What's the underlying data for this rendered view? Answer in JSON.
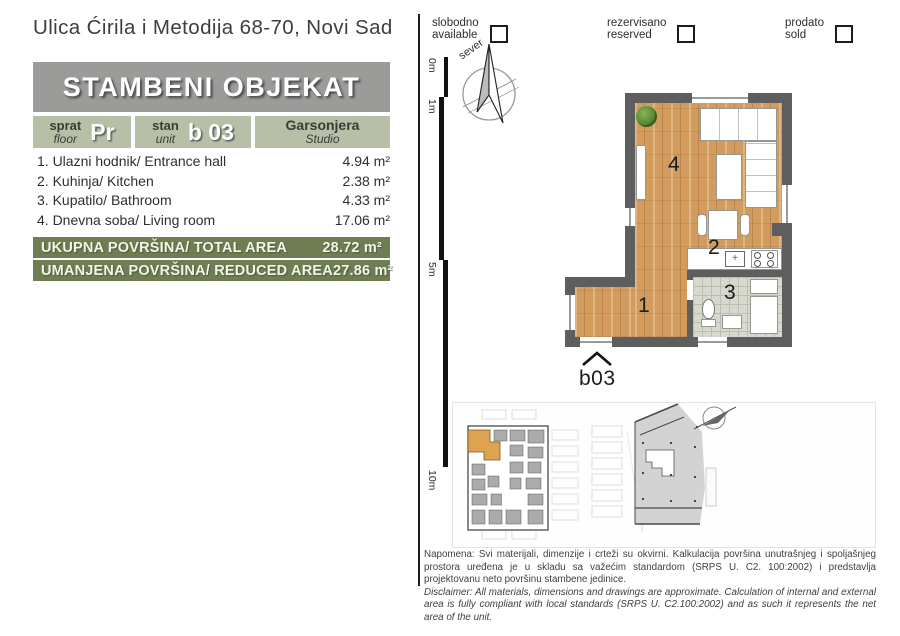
{
  "address": "Ulica Ćirila i Metodija 68-70, Novi Sad",
  "header": {
    "building_label": "STAMBENI OBJEKAT",
    "floor": {
      "sr": "sprat",
      "en": "floor",
      "value": "Pr"
    },
    "unit": {
      "sr": "stan",
      "en": "unit",
      "value": "b 03"
    },
    "apartment_type": {
      "sr": "Garsonjera",
      "en": "Studio"
    }
  },
  "rooms": [
    {
      "label": "1. Ulazni hodnik/ Entrance hall",
      "area": "4.94 m²"
    },
    {
      "label": "2. Kuhinja/ Kitchen",
      "area": "2.38 m²"
    },
    {
      "label": "3. Kupatilo/ Bathroom",
      "area": "4.33 m²"
    },
    {
      "label": "4. Dnevna soba/ Living room",
      "area": "17.06 m²"
    }
  ],
  "totals": {
    "total": {
      "label": "UKUPNA POVRŠINA/ TOTAL AREA",
      "value": "28.72 m²"
    },
    "reduced": {
      "label": "UMANJENA POVRŠINA/ REDUCED AREA",
      "value": "27.86 m²"
    }
  },
  "legend": {
    "available": {
      "sr": "slobodno",
      "en": "available"
    },
    "reserved": {
      "sr": "rezervisano",
      "en": "reserved"
    },
    "sold": {
      "sr": "prodato",
      "en": "sold"
    }
  },
  "compass": {
    "north": "sever"
  },
  "scale_marks": [
    "0m",
    "1m",
    "5m",
    "10m"
  ],
  "plan": {
    "unit_id": "b03",
    "room_numbers": {
      "hall": "1",
      "kitchen": "2",
      "bathroom": "3",
      "living": "4"
    }
  },
  "disclaimer": {
    "sr": "Napomena: Svi materijali, dimenzije i crteži su okvirni. Kalkulacija površina unutrašnjeg i spoljašnjeg prostora uređena je u skladu sa važećim standardom (SRPS U. C2. 100:2002) i predstavlja projektovanu neto površinu stambene jedinice.",
    "en": "Disclaimer: All materials, dimensions and drawings are approximate. Calculation of internal and external area is fully compliant with local standards (SRPS U. C2.100:2002) and as such it represents the net area of the unit."
  },
  "colors": {
    "banner_gray": "#9b9b99",
    "sage_green": "#b7bfa7",
    "olive_bar": "#6e7d52",
    "wood_floor": "#d39c5f",
    "wall_gray": "#5e5e5e",
    "unit_highlight_orange": "#dfa452"
  }
}
